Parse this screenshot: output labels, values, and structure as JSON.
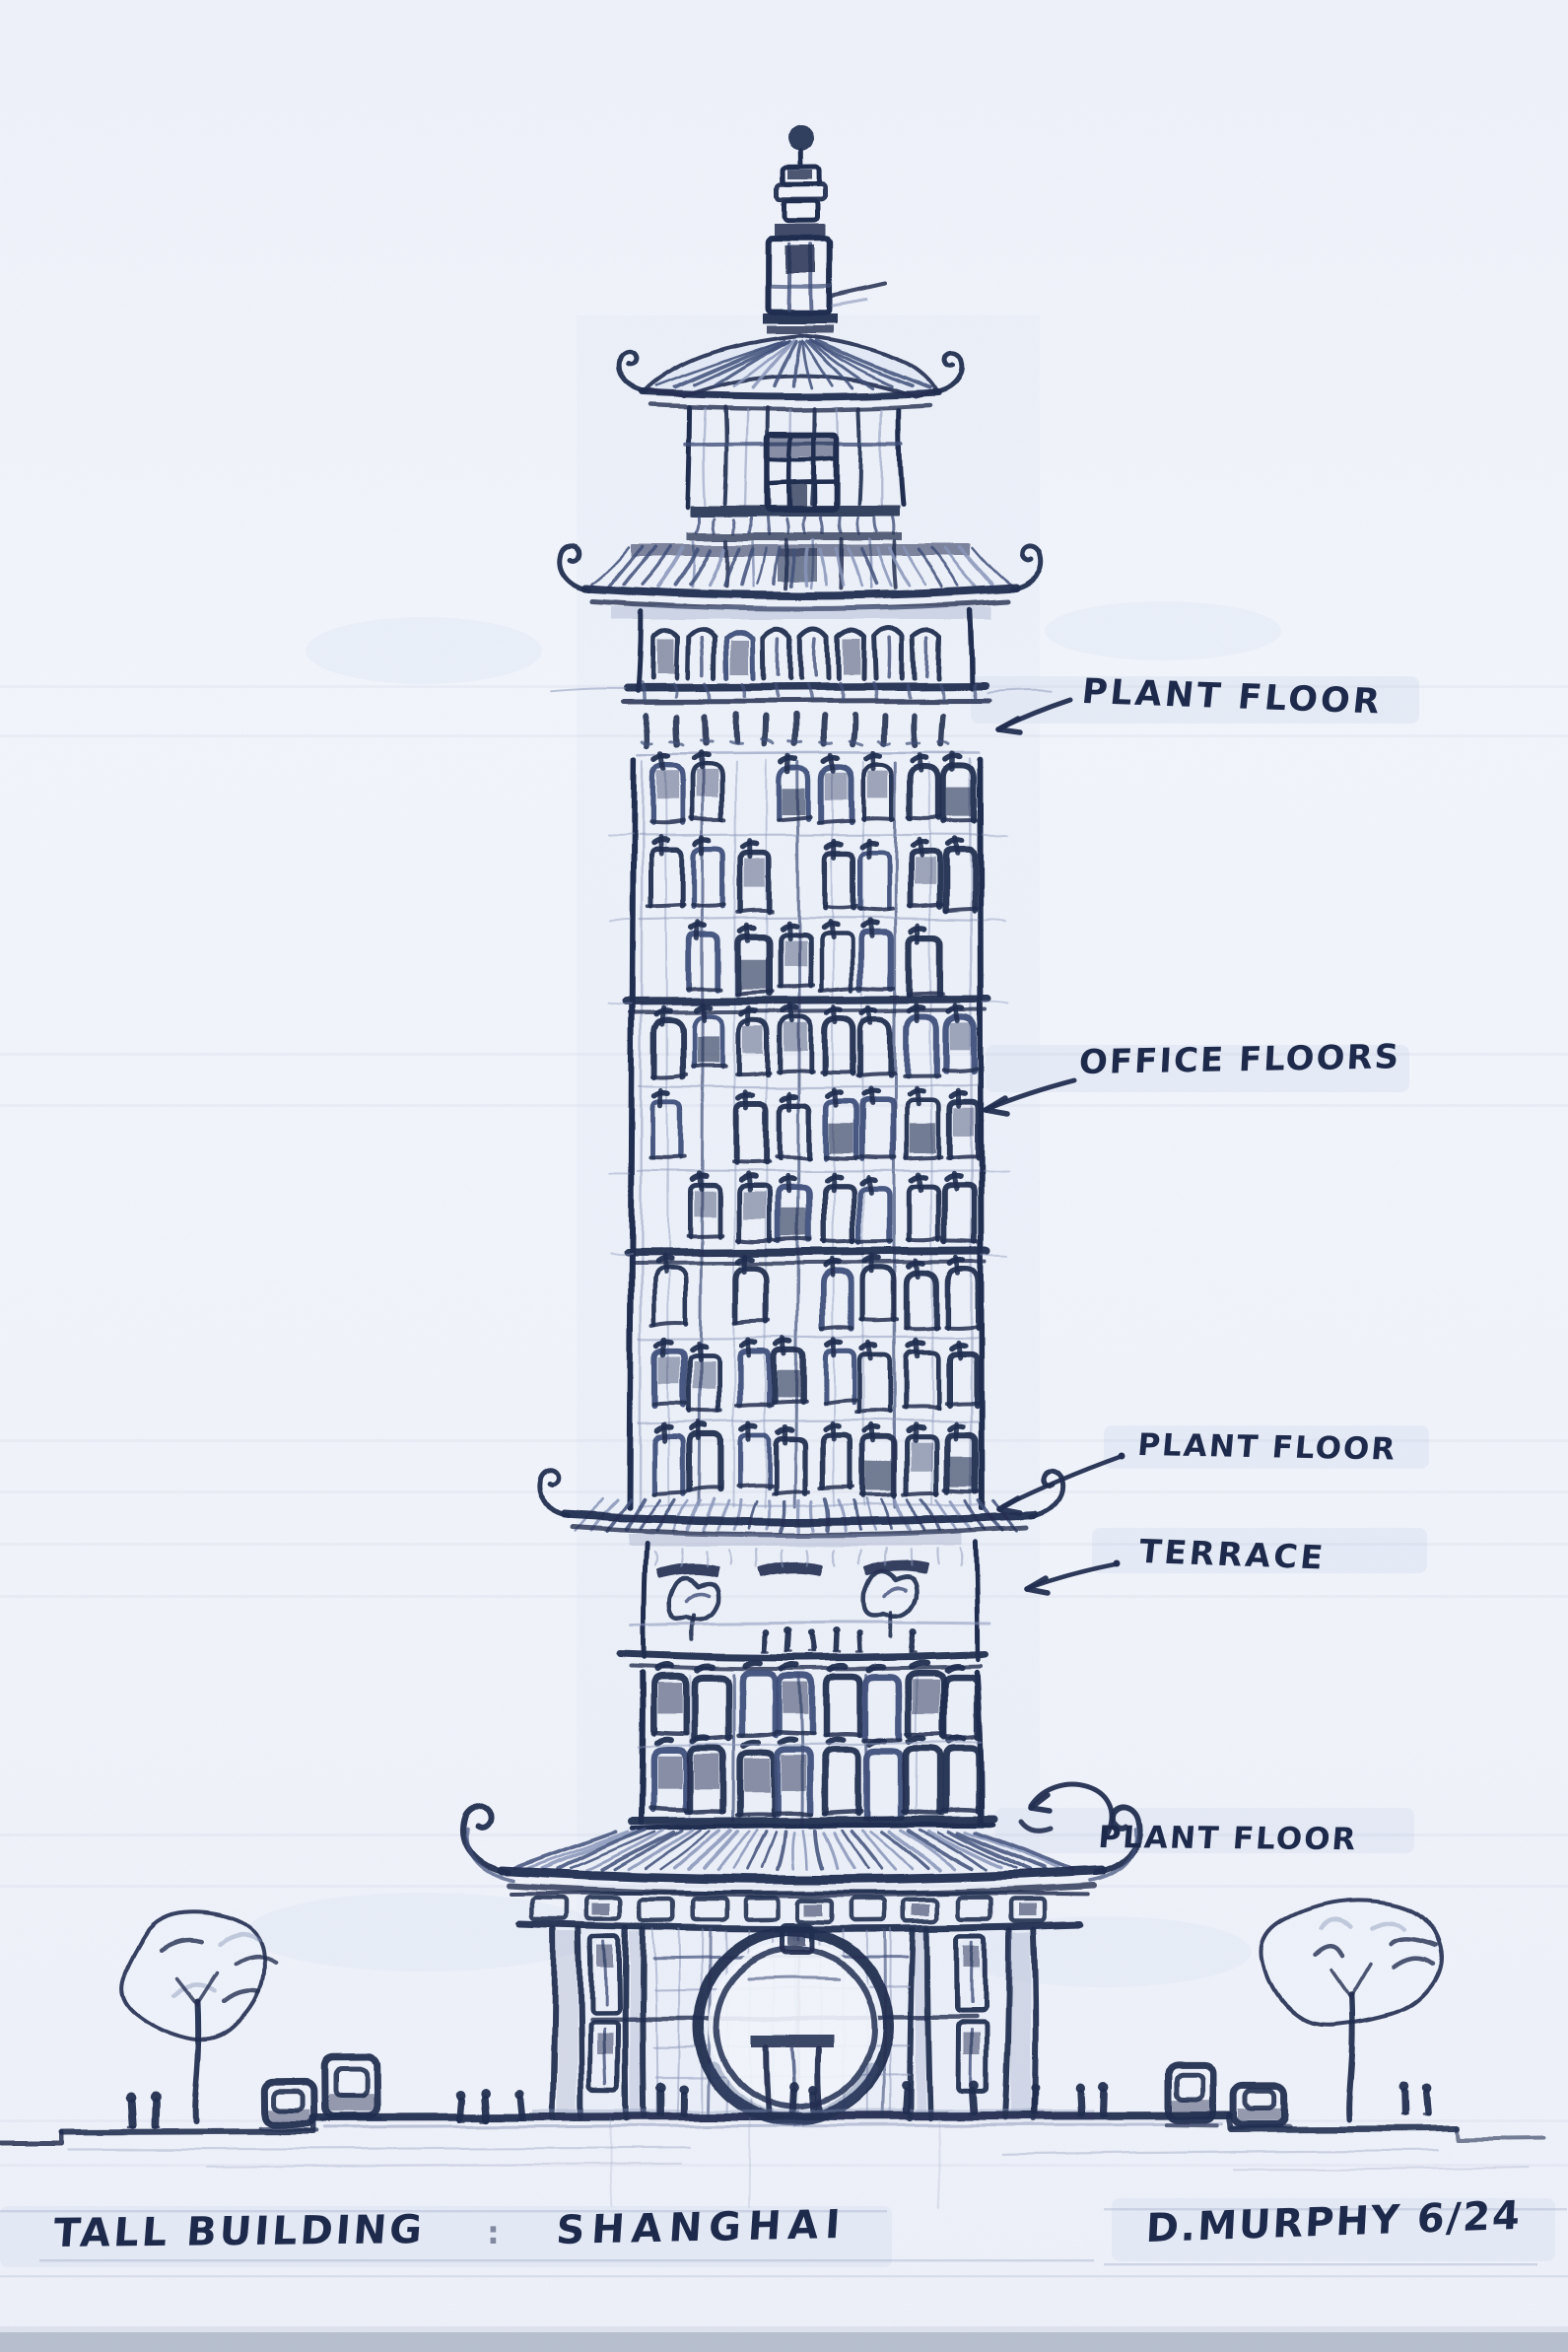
{
  "sketch": {
    "title": {
      "primary": "TALL BUILDING",
      "separator": ":",
      "location": "SHANGHAI"
    },
    "signature": "D.MURPHY 6/24",
    "annotations": [
      {
        "id": "plant-floor-top",
        "label": "PLANT FLOOR"
      },
      {
        "id": "office-floors",
        "label": "OFFICE FLOORS"
      },
      {
        "id": "plant-floor-mid",
        "label": "PLANT FLOOR"
      },
      {
        "id": "terrace",
        "label": "TERRACE"
      },
      {
        "id": "plant-floor-base",
        "label": "PLANT FLOOR"
      }
    ],
    "colors": {
      "ink": "#1f2b4e",
      "ink_soft": "#3d4d78",
      "pencil": "#8794b8",
      "wash": "#dde4f3",
      "paper": "#f1f4fb",
      "photo_edge": "#b7bfce"
    }
  }
}
